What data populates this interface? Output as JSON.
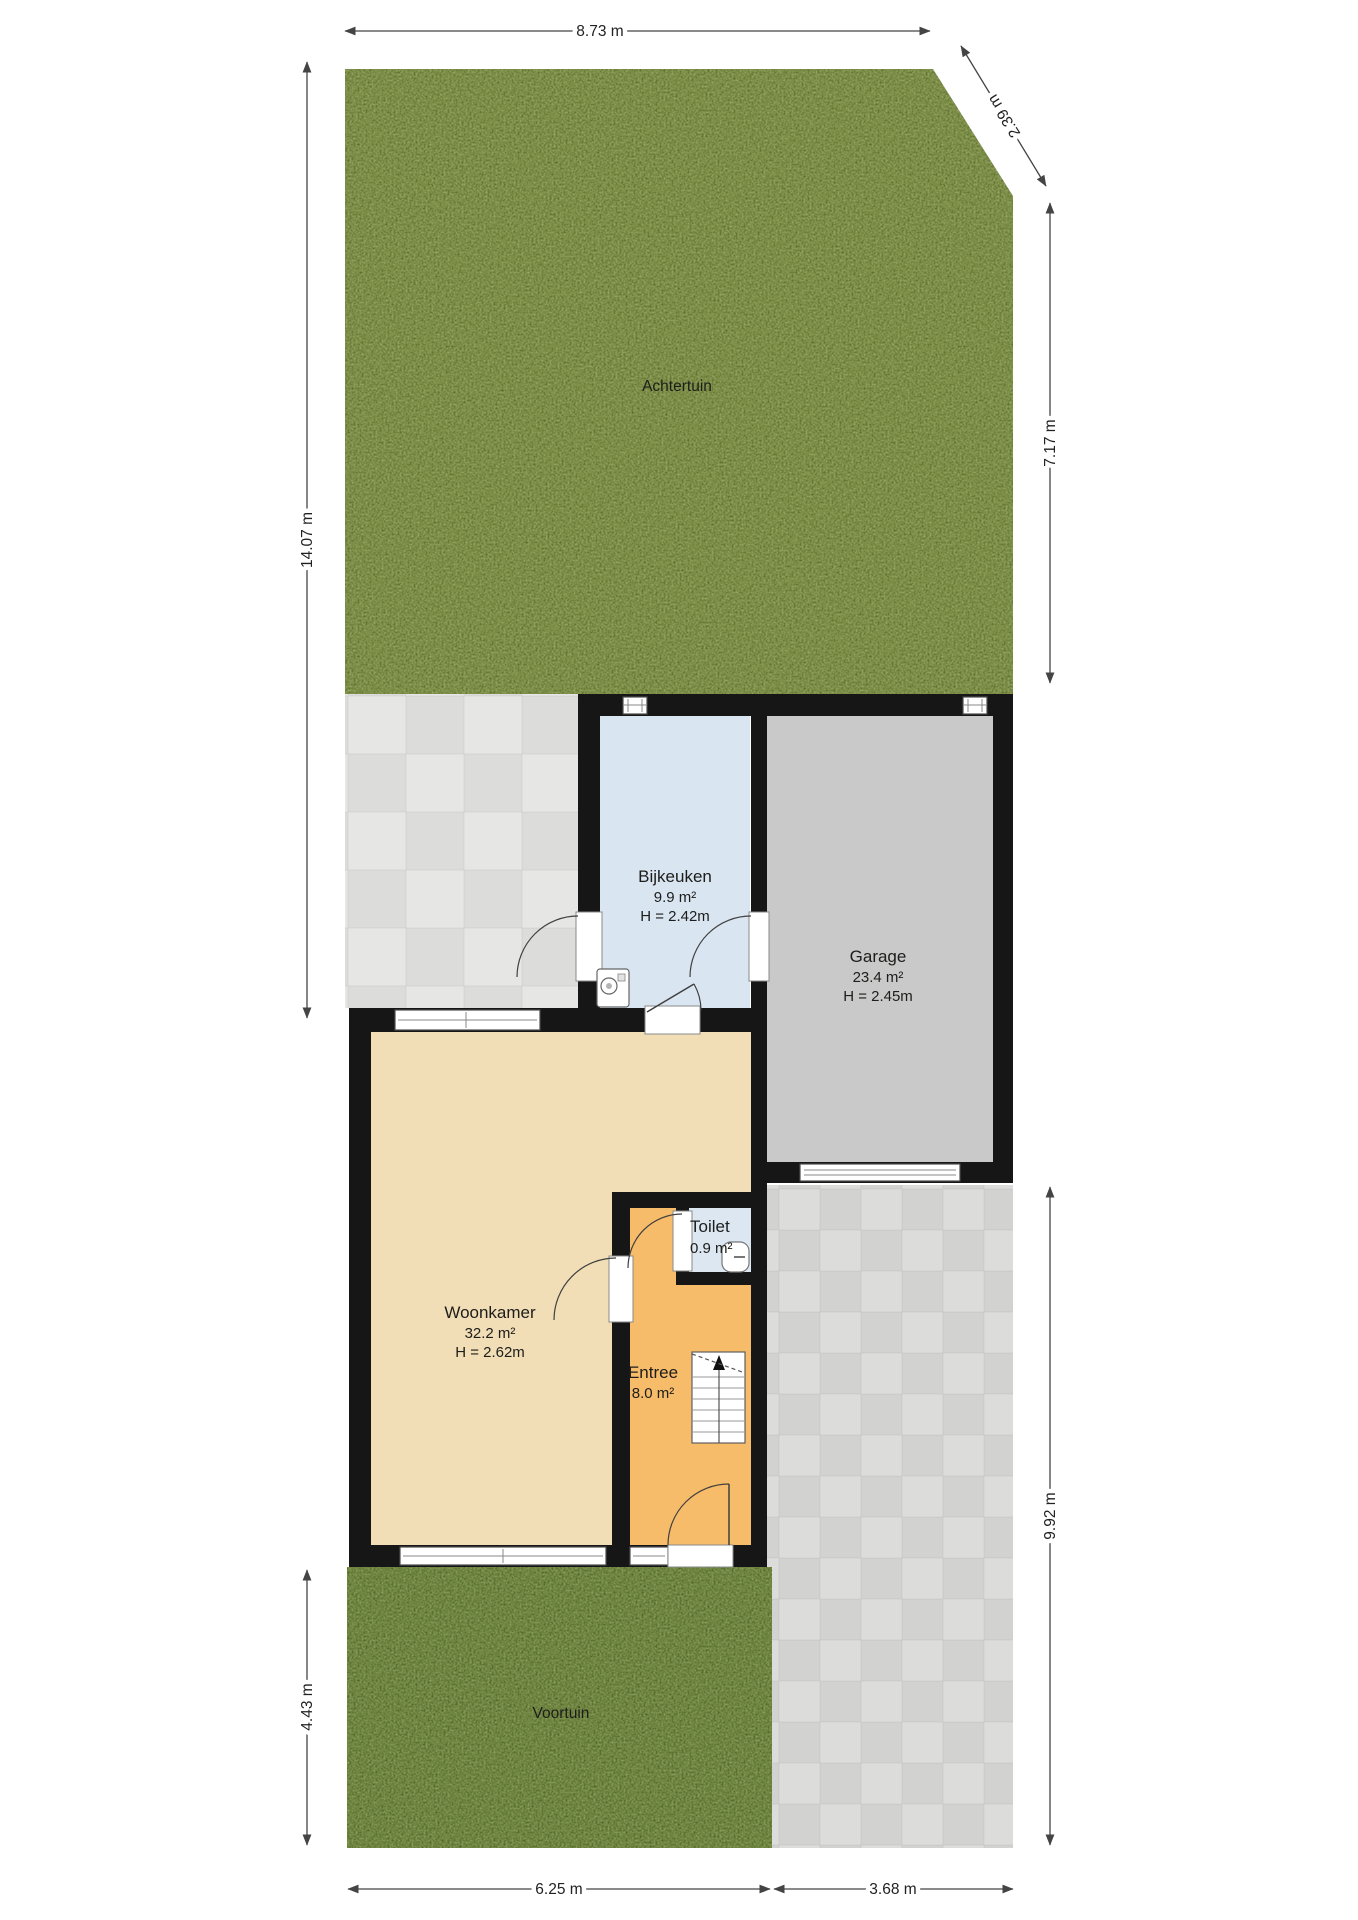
{
  "plan": {
    "areas": {
      "achtertuin": {
        "label": "Achtertuin"
      },
      "voortuin": {
        "label": "Voortuin"
      },
      "bijkeuken": {
        "name": "Bijkeuken",
        "area": "9.9 m²",
        "height": "H = 2.42m"
      },
      "garage": {
        "name": "Garage",
        "area": "23.4 m²",
        "height": "H = 2.45m"
      },
      "woonkamer": {
        "name": "Woonkamer",
        "area": "32.2 m²",
        "height": "H = 2.62m"
      },
      "toilet": {
        "name": "Toilet",
        "area": "0.9 m²"
      },
      "entree": {
        "name": "Entree",
        "area": "8.0 m²"
      }
    },
    "dimensions": {
      "top": "8.73 m",
      "diagonal": "2.39 m",
      "left_upper": "14.07 m",
      "left_lower": "4.43 m",
      "right_upper": "7.17 m",
      "right_lower": "9.92 m",
      "bottom_left": "6.25 m",
      "bottom_right": "3.68 m"
    },
    "colors": {
      "wall": "#161616",
      "grass_back": "#7c8e47",
      "grass_front": "#6f8540",
      "patio": "#dcdcdb",
      "driveway": "#d2d2d1",
      "garage_floor": "#c9c9c9",
      "bijkeuken_floor": "#d9e5f1",
      "toilet_floor": "#dce7f2",
      "woonkamer_floor": "#f2deb6",
      "entree_floor": "#f6bc69",
      "stairs": "#ffffff",
      "dimension": "#444444"
    }
  }
}
